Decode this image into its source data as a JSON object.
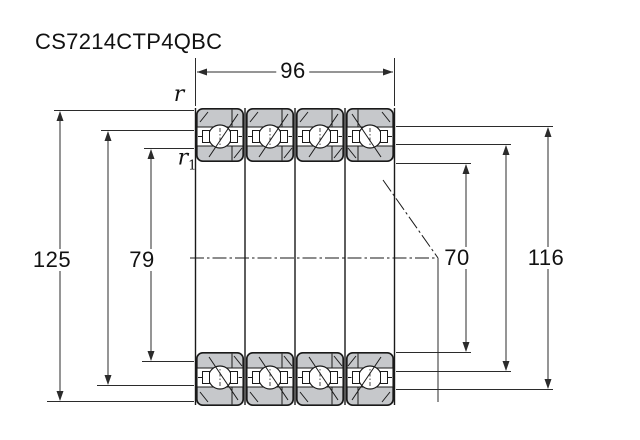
{
  "drawing": {
    "title": "CS7214CTP4QBC",
    "dimensions": {
      "total_width": "96",
      "outer_diameter": "125",
      "inner_shoulder_diameter": "79",
      "bore_diameter": "70",
      "outer_shoulder_diameter": "116"
    },
    "radius_labels": {
      "outer_chamfer": "r",
      "inner_chamfer_base": "r",
      "inner_chamfer_sub": "1"
    },
    "colors": {
      "ring_fill": "#c6c8cb",
      "line": "#1a1a1a",
      "background": "#ffffff"
    }
  }
}
